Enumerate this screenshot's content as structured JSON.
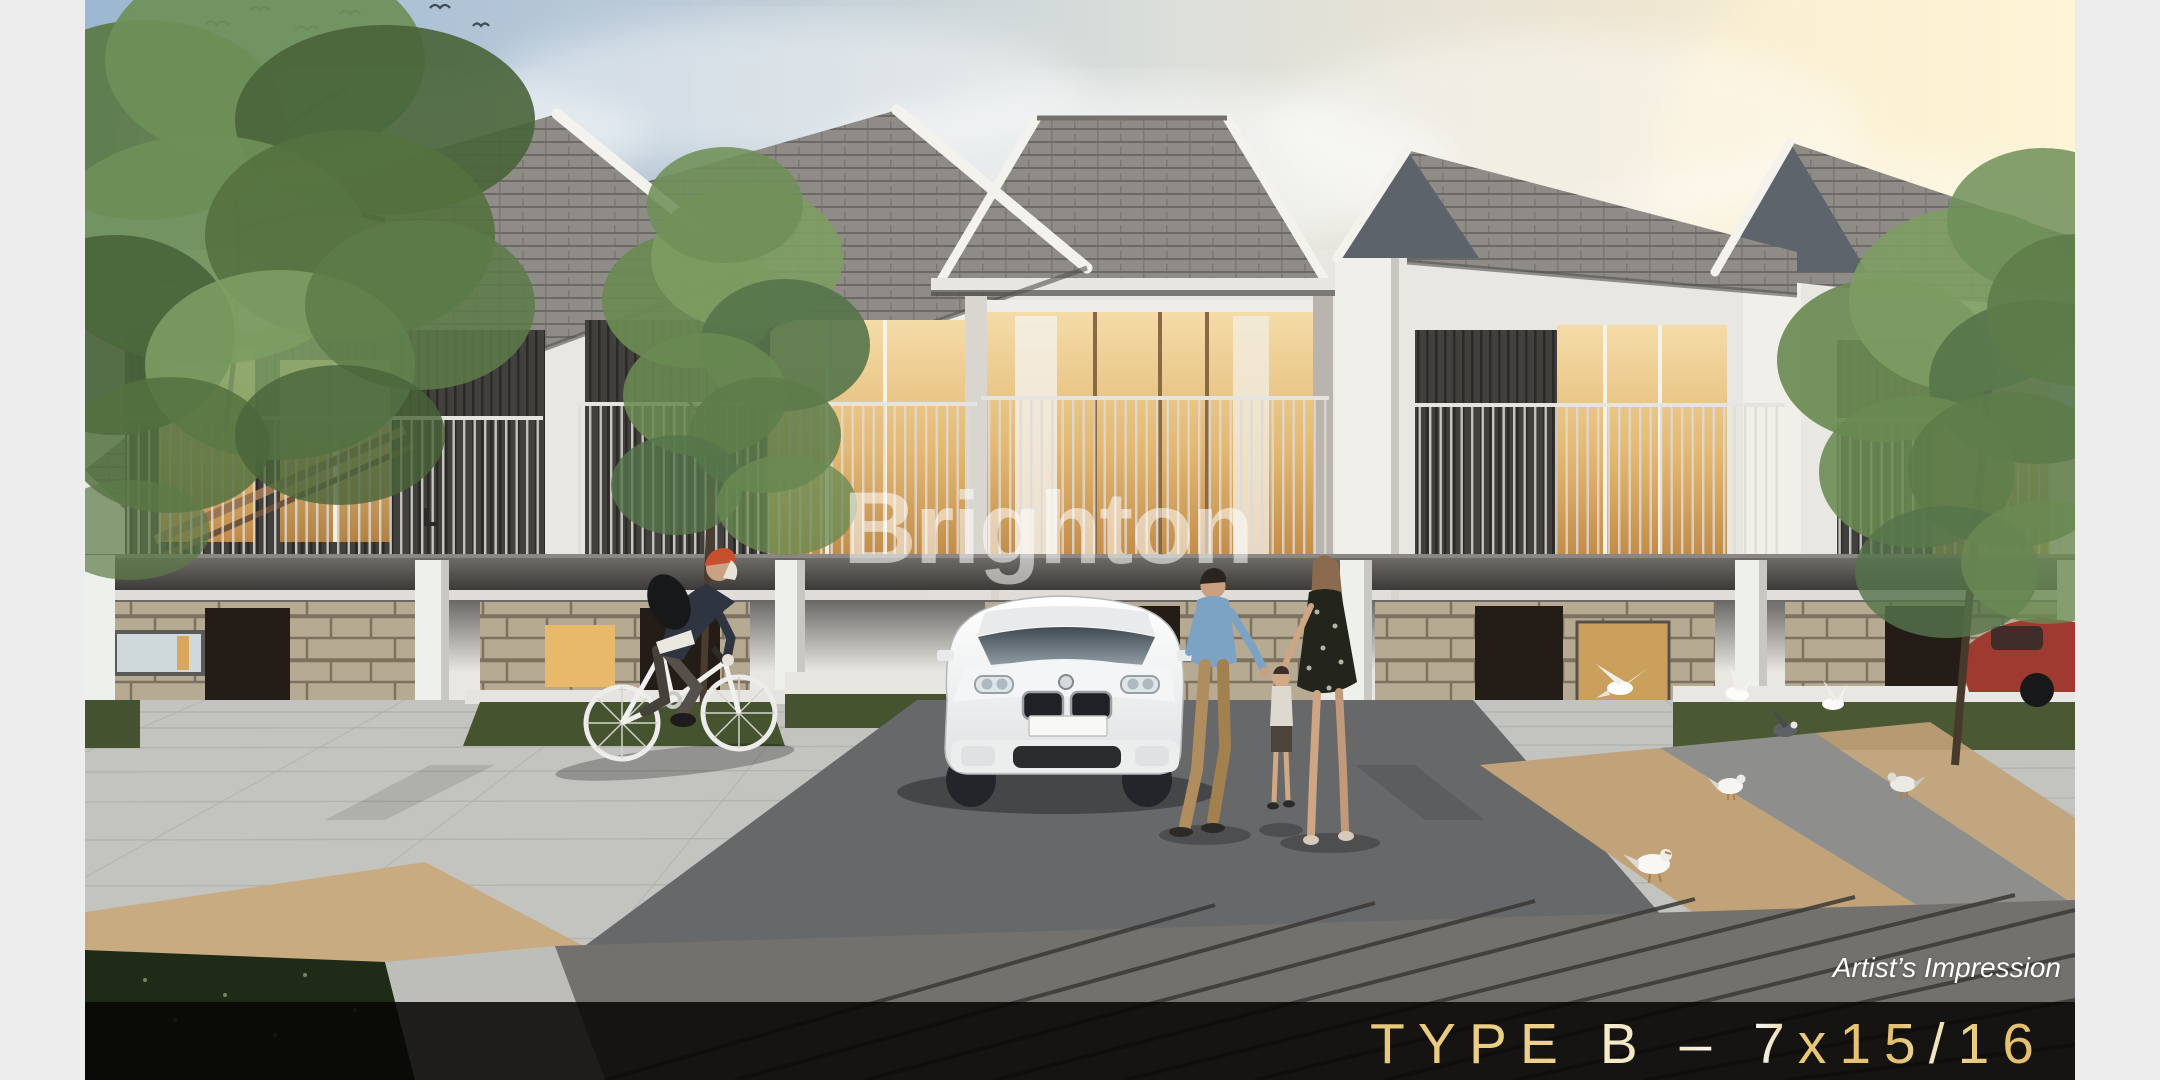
{
  "overlays": {
    "watermark": "Brighton",
    "caption": "Artist’s Impression",
    "banner_title": "TYPE B – 7x15/16"
  },
  "banner": {
    "background": "rgba(8,7,6,0.88)",
    "title_gold": "#e8c878",
    "title_cream": "#f6edd2",
    "title_white": "#fdfcf6"
  },
  "palette": {
    "page_margin": "#ededed",
    "watermark_color": "rgba(255,255,255,0.55)",
    "sky_left": "#9cb7d1",
    "sky_right": "#f7eed8",
    "roof_shingle": "#8e8b86",
    "fascia_white": "#f4f2ec",
    "stone_wall": "#b4a892",
    "window_glow": "#e9c37e",
    "slat_wall": "#3e3d3b",
    "pavement_gray": "#c3c3c0",
    "driveway_dark": "#66686a",
    "paver_tan": "#c2a379",
    "grass_green": "#46532f",
    "deck_wood": "#73716d"
  },
  "scene_alt": "Artist impression render of a row of modern two-storey terrace houses with carports, balconies, a white SUV, a family with a child, a cyclist and pigeons on a paved plaza"
}
